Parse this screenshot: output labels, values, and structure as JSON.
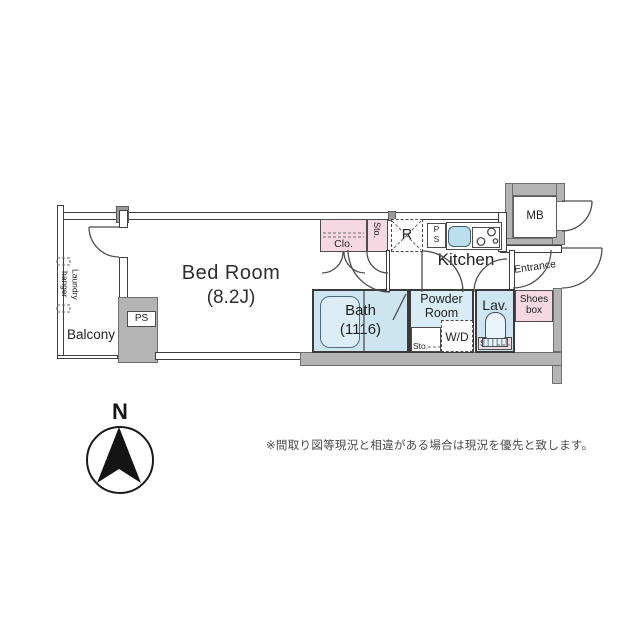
{
  "plan": {
    "rooms": {
      "bedroom": {
        "name": "Bed Room",
        "size": "(8.2J)"
      },
      "balcony": {
        "label": "Balcony"
      },
      "laundry_hanger": {
        "line1": "Laundry",
        "line2": "hanger"
      },
      "kitchen": {
        "label": "Kitchen"
      },
      "entrance": {
        "label": "Entrance"
      },
      "bath": {
        "name": "Bath",
        "size": "(1116)"
      },
      "powder_room": {
        "line1": "Powder",
        "line2": "Room"
      },
      "lav": {
        "label": "Lav."
      },
      "meter_box": {
        "label": "MB"
      }
    },
    "fixtures": {
      "closet": {
        "label": "Clo."
      },
      "storage_hall": {
        "label": "Sto."
      },
      "refrigerator": {
        "label": "R"
      },
      "pipe_space_kitchen": {
        "line1": "P",
        "line2": "S"
      },
      "pipe_space_lower": {
        "label": "PS"
      },
      "washer_dryer": {
        "label": "W/D"
      },
      "storage_powder": {
        "label": "Sto."
      },
      "storage_lav": {
        "label": "Sto."
      },
      "shoes_box": {
        "line1": "Shoes",
        "line2": "box"
      }
    }
  },
  "compass": {
    "label": "N"
  },
  "disclaimer": "※間取り図等現況と相違がある場合は現況を優先と致します。",
  "colors": {
    "room_blue": "#cde5f0",
    "powder_blue": "#d8ecf5",
    "fixture_pink": "#f6d8e2",
    "wall_gray": "#b4b4b4",
    "sink_blue": "#bcdff0",
    "tub_blue": "#dcedf6",
    "line": "#3d3d3d"
  }
}
